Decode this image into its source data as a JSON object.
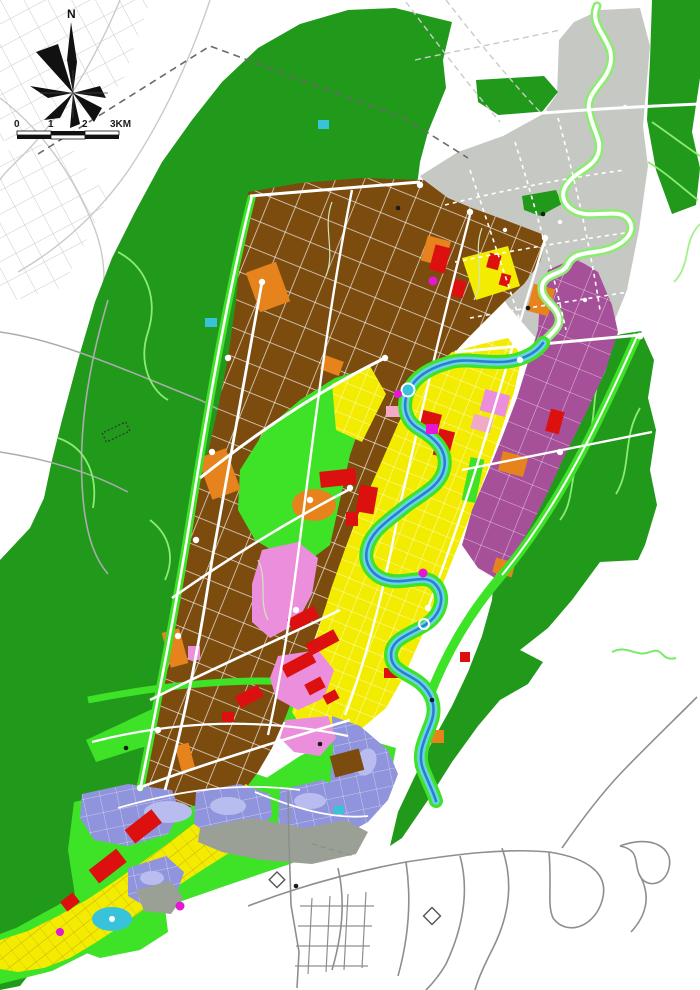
{
  "map": {
    "kind": "urban master land-use plan",
    "compass": {
      "label": "N"
    },
    "scale_bar": {
      "labels": [
        "0",
        "1",
        "2",
        "3KM"
      ]
    }
  },
  "colors": {
    "dark_green": "#21991b",
    "bright_green": "#3ee327",
    "light_green": "#8cec72",
    "brown": "#7c4c0f",
    "yellow": "#f3ec00",
    "purple": "#a6509a",
    "periwinkle": "#9094dc",
    "periwinkle_light": "#b9bcee",
    "pink": "#eb8fdd",
    "salmon": "#f2a9c6",
    "red": "#dd1010",
    "orange": "#e6831c",
    "magenta": "#e517d4",
    "cyan": "#39c3da",
    "river_cyan": "#68d4e8",
    "river_blue": "#2e7ecf",
    "gray_urban": "#c6c9c3",
    "gray_zone": "#9ba096",
    "road_gray": "#c8cbc8",
    "road_mid": "#a9adab",
    "road_dark": "#8c908c",
    "olive_road": "#b5901f",
    "outline": "#161616"
  }
}
